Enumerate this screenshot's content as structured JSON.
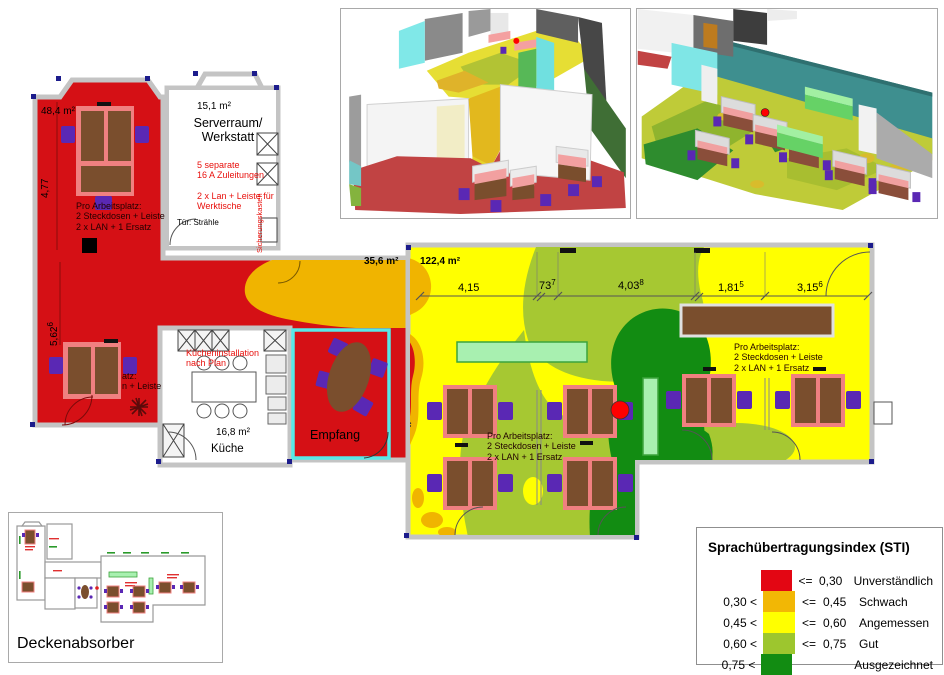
{
  "palette": {
    "sti_red": "#d51015",
    "sti_orange": "#f0b400",
    "sti_yellow": "#ffff00",
    "sti_lightgreen": "#9dc62e",
    "sti_darkgreen": "#128c12"
  },
  "plan": {
    "rooms": {
      "room_a": {
        "area": "48,4 m²",
        "dim_height": "4,77",
        "dim_height2": "5,62",
        "dim_height2_sup": "6"
      },
      "serverraum": {
        "area": "15,1 m²",
        "name_line1": "Serverraum/",
        "name_line2": "Werkstatt",
        "note1_line1": "5 separate",
        "note1_line2": "16 A Zuleitungen",
        "note2_line1": "2 x Lan + Leiste für",
        "note2_line2": "Werktische",
        "side_label": "Sicherungskasten",
        "door_note": "Tür: Strähle"
      },
      "corridor": {
        "area": "35,6 m²"
      },
      "kueche": {
        "area": "16,8 m²",
        "name": "Küche",
        "note_line1": "Kücheninstallation",
        "note_line2": "nach Plan"
      },
      "empfang": {
        "name": "Empfang"
      },
      "bigroom": {
        "area": "122,4 m²"
      }
    },
    "workplace_note": {
      "l1": "Pro Arbeitsplatz:",
      "l2": "2 Steckdosen + Leiste",
      "l3": "2 x LAN + 1 Ersatz"
    },
    "workplace_note_partial": {
      "l1": "atz:",
      "l2": "n + Leiste"
    },
    "dims": [
      {
        "v": "4,15",
        "sup": ""
      },
      {
        "v": "73",
        "sup": "7"
      },
      {
        "v": "4,03",
        "sup": "8"
      },
      {
        "v": "1,81",
        "sup": "5"
      },
      {
        "v": "3,15",
        "sup": "6"
      }
    ]
  },
  "thumbnail": {
    "caption": "Deckenabsorber"
  },
  "legend": {
    "title": "Sprachübertragungsindex (STI)",
    "rows": [
      {
        "lower": "",
        "color": "#e30613",
        "op": "<=",
        "upper": "0,30",
        "label": "Unverständlich"
      },
      {
        "lower": "0,30 <",
        "color": "#f2b705",
        "op": "<=",
        "upper": "0,45",
        "label": "Schwach"
      },
      {
        "lower": "0,45 <",
        "color": "#ffff00",
        "op": "<=",
        "upper": "0,60",
        "label": "Angemessen"
      },
      {
        "lower": "0,60 <",
        "color": "#9dc62e",
        "op": "<=",
        "upper": "0,75",
        "label": "Gut"
      },
      {
        "lower": "0,75 <",
        "color": "#128c12",
        "op": "",
        "upper": "",
        "label": "Ausgezeichnet"
      }
    ]
  }
}
